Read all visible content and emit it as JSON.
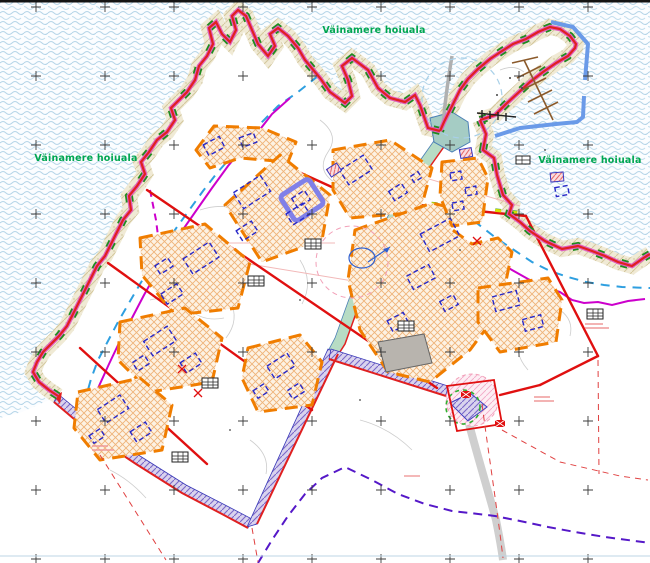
{
  "map": {
    "type": "detail-plan cadastral map",
    "labels": {
      "protected_area": "Väinamere hoiuala"
    },
    "colors": {
      "label_green": "#00a651",
      "coast_boundary_red": "#e02020",
      "coast_boundary_magenta": "#e060c0",
      "protected_area_dash_green": "#1f8c1f",
      "water_wave_blue": "#b5d5e8",
      "shore_beige": "#f2edda",
      "building_envelope_orange": "#f07d00",
      "planned_building_blue": "#2828c8",
      "exclusion_line_magenta": "#cc00cc",
      "buffer_line_blue": "#2e9fe0",
      "road_corridor_green": "#b7dcc4",
      "road_strip_purple": "#7a68c8",
      "existing_building_gray": "#b8b4ae",
      "marina_line_blue": "#6a9ae8",
      "pier_brown": "#8b5a2b",
      "outside_boundary_purple_dash": "#5518c8"
    }
  }
}
